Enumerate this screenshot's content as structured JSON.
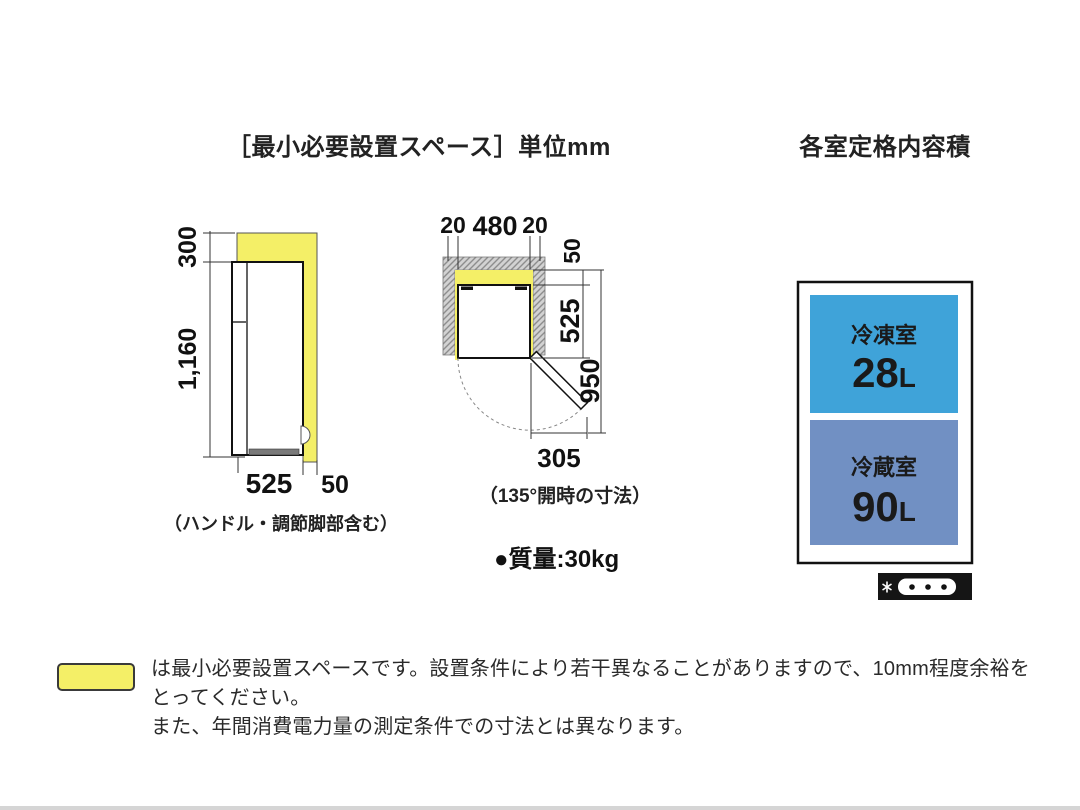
{
  "titles": {
    "install_space": "［最小必要設置スペース］単位mm",
    "capacity": "各室定格内容積"
  },
  "side_view": {
    "dims": {
      "top_clearance": "300",
      "height": "1,160",
      "width": "525",
      "rear_clearance": "50"
    },
    "caption": "（ハンドル・調節脚部含む）",
    "clearance_color": "#f4ef67"
  },
  "top_view": {
    "dims": {
      "left_gap": "20",
      "width": "480",
      "right_gap": "20",
      "rear_gap": "50",
      "depth": "525",
      "total_depth": "950",
      "door_open": "305"
    },
    "caption": "（135°開時の寸法）",
    "mass": "●質量:30kg"
  },
  "capacity_box": {
    "freezer": {
      "label": "冷凍室",
      "value": "28",
      "unit": "L",
      "color": "#3fa3d9"
    },
    "fridge": {
      "label": "冷蔵室",
      "value": "90",
      "unit": "L",
      "color": "#7190c3"
    }
  },
  "legend": {
    "swatch_color": "#f4ef67",
    "line1": "は最小必要設置スペースです。設置条件により若干異なることがありますので、10mm程度余裕をとってください。",
    "line2": "また、年間消費電力量の測定条件での寸法とは異なります。"
  }
}
